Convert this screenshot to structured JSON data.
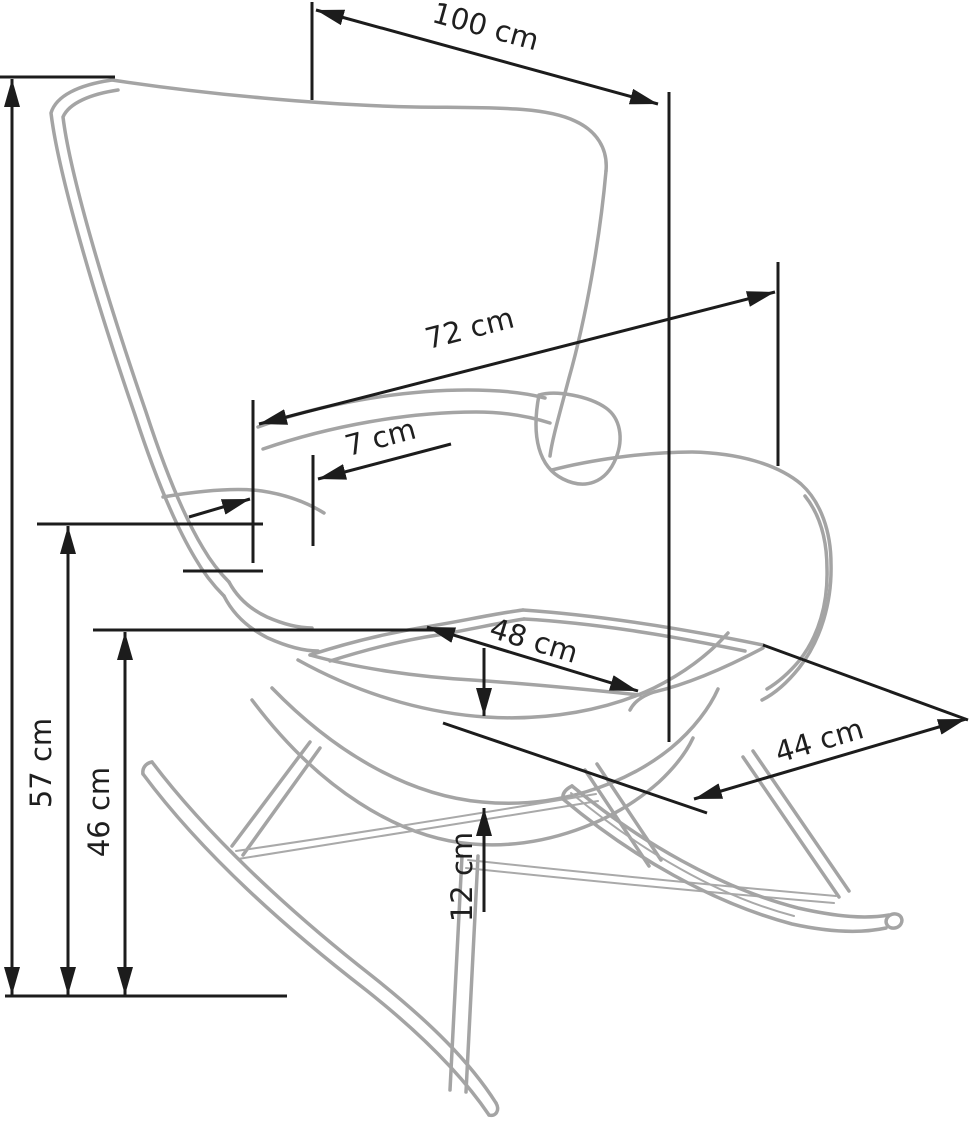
{
  "diagram": {
    "subject": "rocking-chair-dimension-drawing",
    "unit": "cm",
    "colors": {
      "background": "#ffffff",
      "chair_outline": "#a4a4a4",
      "dimension_lines": "#1c1c1c",
      "label_text": "#1f1f1f"
    },
    "dimensions": {
      "overall_width": {
        "label": "100 cm",
        "value": 100
      },
      "backrest_width": {
        "label": "72 cm",
        "value": 72
      },
      "wing_offset": {
        "label": "7 cm",
        "value": 7
      },
      "seat_width": {
        "label": "48 cm",
        "value": 48
      },
      "seat_depth": {
        "label": "44 cm",
        "value": 44
      },
      "armrest_height": {
        "label": "57 cm",
        "value": 57
      },
      "seat_height": {
        "label": "46 cm",
        "value": 46
      },
      "seat_thickness": {
        "label": "12 cm",
        "value": 12
      }
    }
  }
}
